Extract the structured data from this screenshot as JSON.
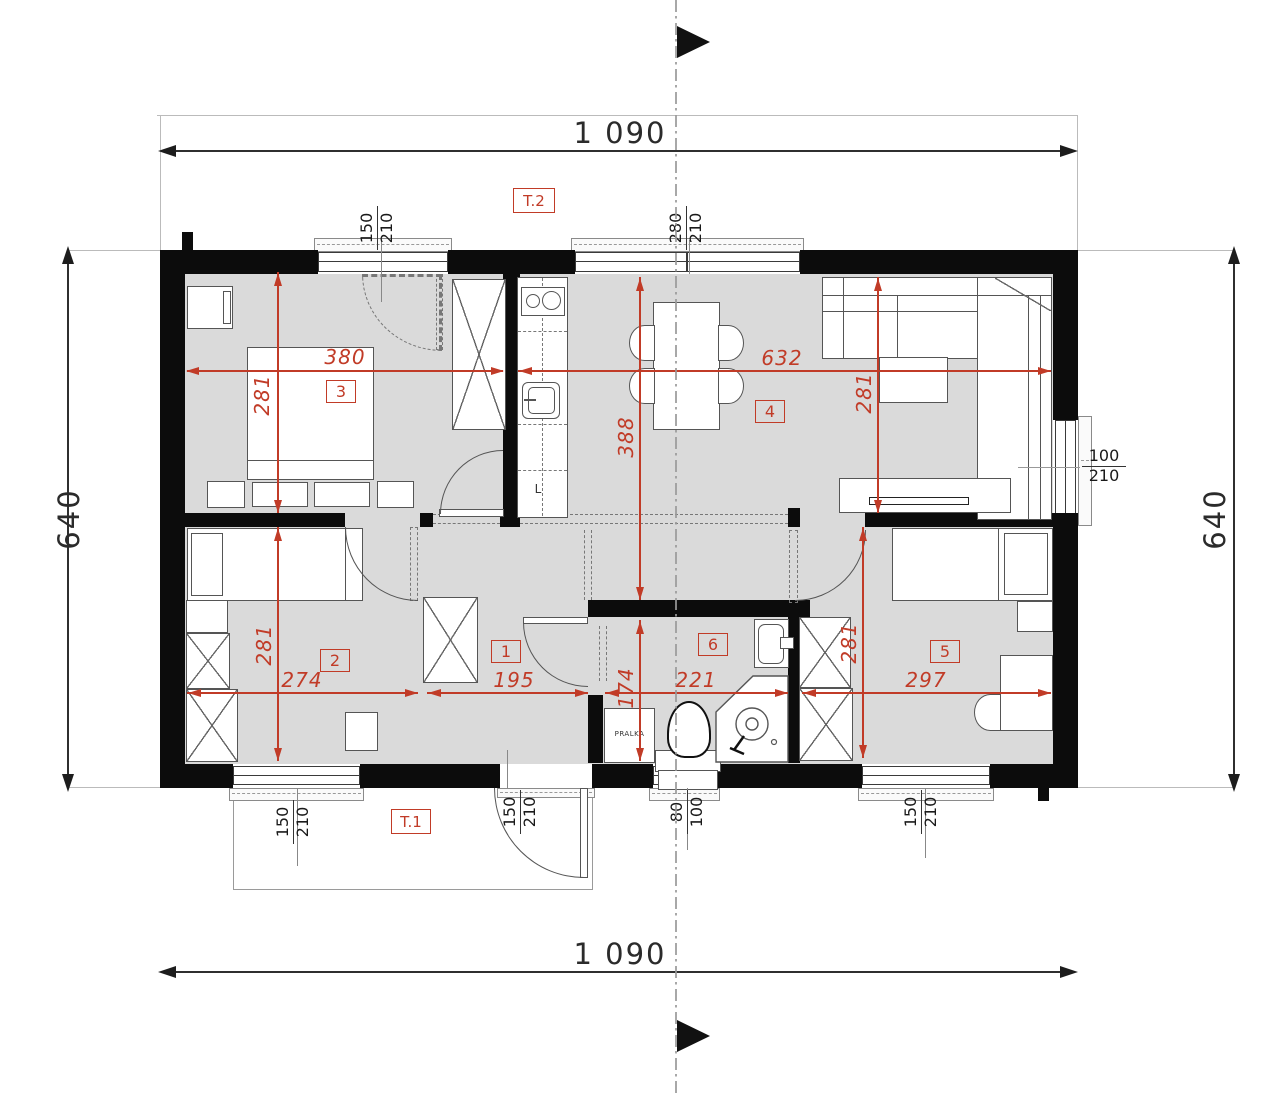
{
  "plan": {
    "overall": {
      "top": "1 090",
      "bottom": "1 090",
      "left": "640",
      "right": "640"
    },
    "rooms": {
      "hall": {
        "no": "1",
        "w": "195"
      },
      "bedroom2": {
        "no": "2",
        "w": "274",
        "h": "281"
      },
      "bedroom3": {
        "no": "3",
        "w": "380",
        "h": "281"
      },
      "living": {
        "no": "4",
        "w": "632",
        "h": "281",
        "depth": "388"
      },
      "bedroom5": {
        "no": "5",
        "w": "297",
        "h": "281"
      },
      "bathroom": {
        "no": "6",
        "w": "221",
        "h": "174"
      }
    },
    "terraces": {
      "t1": "T.1",
      "t2": "T.2"
    },
    "windows": {
      "balcony3": {
        "w": "150",
        "h": "210"
      },
      "living_top": {
        "w": "280",
        "h": "210"
      },
      "living_side": {
        "w": "100",
        "h": "210"
      },
      "bedroom2": {
        "w": "150",
        "h": "210"
      },
      "entry": {
        "w": "150",
        "h": "210"
      },
      "bathroom": {
        "w": "80",
        "h": "100"
      },
      "bedroom5": {
        "w": "150",
        "h": "210"
      }
    },
    "labels": {
      "washer": "PRALKA",
      "fridge": "L"
    },
    "colors": {
      "dim_red": "#c13b27",
      "wall": "#0c0c0c",
      "floor": "#dadada"
    }
  }
}
